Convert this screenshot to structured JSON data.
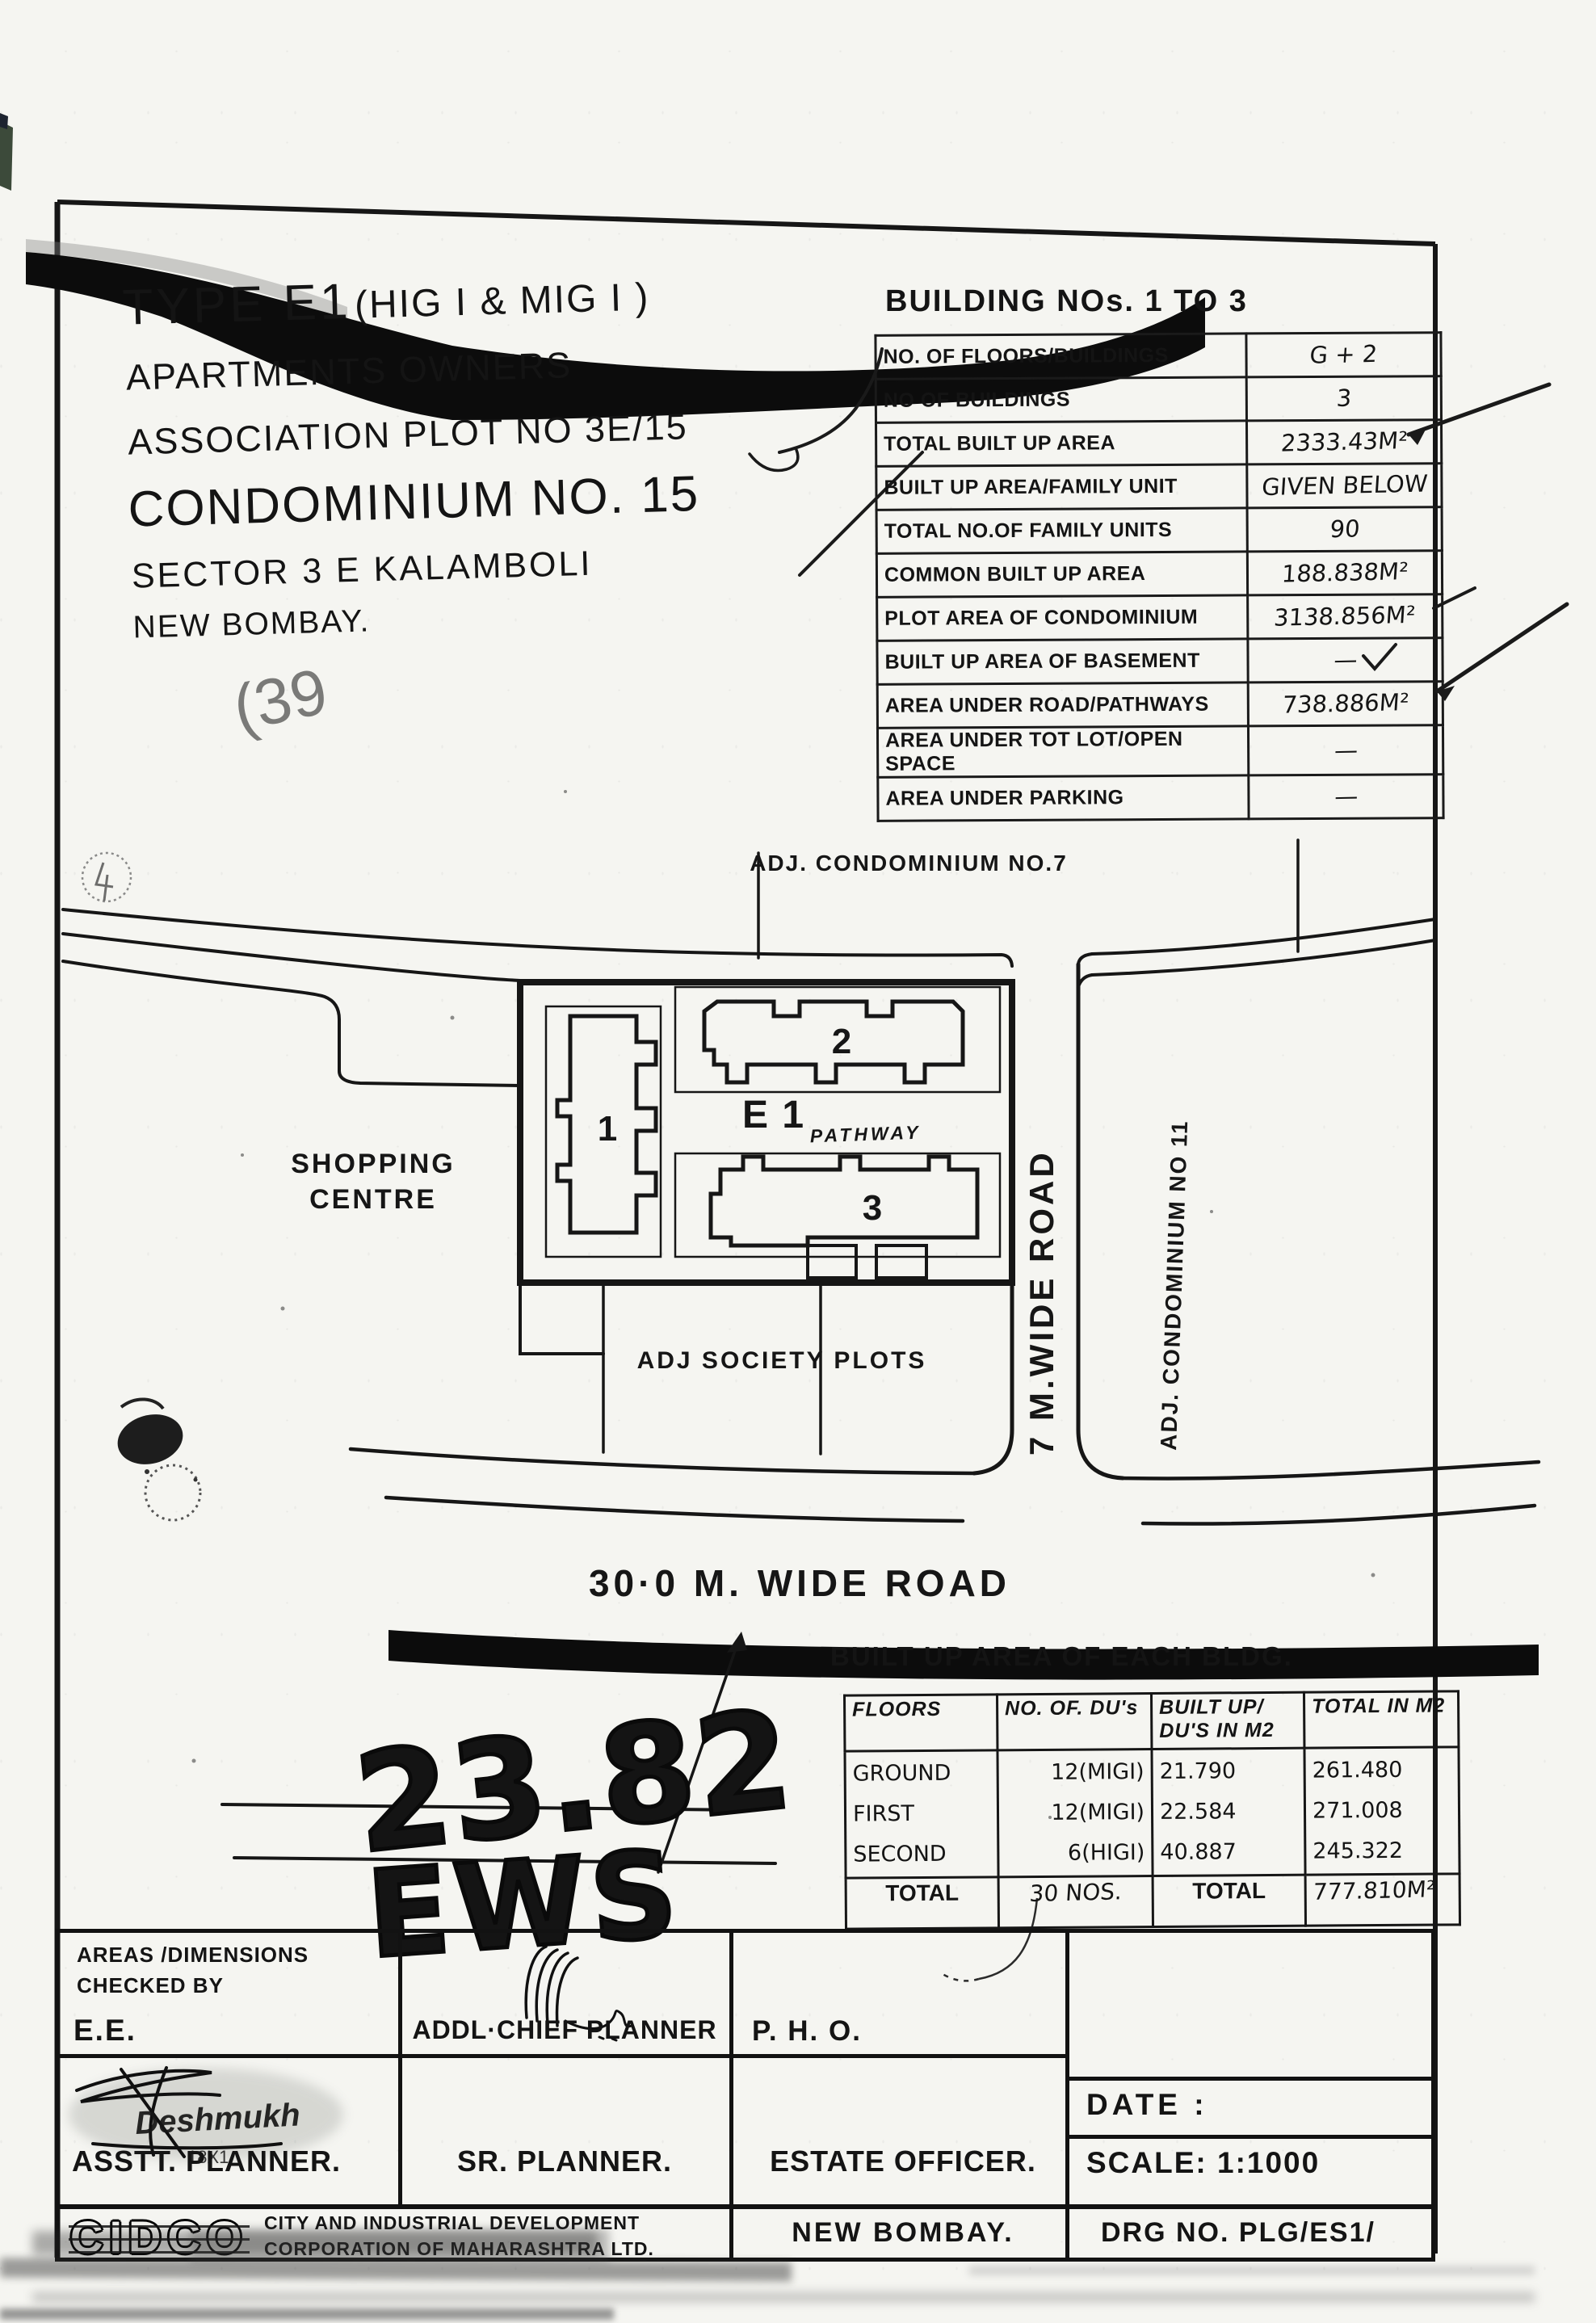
{
  "title_block": {
    "line1a": "TYPE   E1",
    "line1b": "(HIG I & MIG I )",
    "line2": "APARTMENTS  OWNERS",
    "line3": "ASSOCIATION   PLOT  NO 3E/15",
    "line4": "CONDOMINIUM NO. 15",
    "line5": "SECTOR 3 E  KALAMBOLI",
    "line6": "NEW BOMBAY."
  },
  "building_table": {
    "title": "BUILDING  NOs. 1 TO 3",
    "rows": [
      {
        "label": "NO. OF FLOORS/BUILDINGS",
        "value": "G + 2"
      },
      {
        "label": "NO  OF  BUILDINGS",
        "value": "3"
      },
      {
        "label": "TOTAL BUILT UP  AREA",
        "value": "2333.43M²"
      },
      {
        "label": "BUILT  UP AREA/FAMILY  UNIT",
        "value": "GIVEN BELOW"
      },
      {
        "label": "TOTAL  NO.OF  FAMILY  UNITS",
        "value": "90"
      },
      {
        "label": "COMMON  BUILT UP  AREA",
        "value": "188.838M²"
      },
      {
        "label": "PLOT  AREA  OF  CONDOMINIUM",
        "value": "3138.856M²"
      },
      {
        "label": "BUILT UP AREA OF BASEMENT",
        "value": "—"
      },
      {
        "label": "AREA  UNDER  ROAD/PATHWAYS",
        "value": "738.886M²"
      },
      {
        "label": "AREA  UNDER  TOT LOT/OPEN SPACE",
        "value": "—"
      },
      {
        "label": "AREA UNDER  PARKING",
        "value": "—"
      }
    ]
  },
  "plan": {
    "adj_condo_7": "ADJ. CONDOMINIUM  NO.7",
    "shopping_line1": "SHOPPING",
    "shopping_line2": "CENTRE",
    "bldg1": "1",
    "bldg2": "2",
    "bldg3": "3",
    "e1": "E 1",
    "pathway": "PATHWAY",
    "adj_society": "ADJ  SOCIETY   PLOTS",
    "road7": "7 M.WIDE ROAD",
    "adj_condo_11": "ADJ.  CONDOMINIUM  NO 11",
    "road30": "30·0 M. WIDE ROAD"
  },
  "floors_table": {
    "title": "BUILT UP  AREA  OF  EACH  BLDG.",
    "headers": [
      "FLOORS",
      "NO. OF. DU's",
      "BUILT UP/ DU'S IN M2",
      "TOTAL IN M2"
    ],
    "rows": [
      [
        "GROUND",
        "12(MIGI)",
        "21.790",
        "261.480"
      ],
      [
        "FIRST",
        "12(MIGI)",
        "22.584",
        "271.008"
      ],
      [
        "SECOND",
        "6(HIGI)",
        "40.887",
        "245.322"
      ]
    ],
    "total": [
      "TOTAL",
      "30 NOS.",
      "TOTAL",
      "777.810M²"
    ]
  },
  "signature_block": {
    "checked_line1": "AREAS /DIMENSIONS",
    "checked_line2": "CHECKED BY",
    "ee": "E.E.",
    "addl_chief_planner": "ADDL·CHIEF  PLANNER",
    "pho": "P. H. O.",
    "asst_planner": "ASSTT. PLANNER.",
    "sr_planner": "SR. PLANNER.",
    "estate_officer": "ESTATE  OFFICER.",
    "date_label": "DATE  :",
    "scale_label": "SCALE: 1:1000",
    "logo": "CIDCO",
    "org_line1": "CITY AND INDUSTRIAL DEVELOPMENT",
    "org_line2": "CORPORATION OF MAHARASHTRA LTD.",
    "new_bombay": "NEW  BOMBAY.",
    "drg_no": "DRG NO.  PLG/ES1/"
  },
  "annotations": {
    "hand_number": "23.82",
    "hand_word": "EWS",
    "pencil_note": "(39",
    "sig_name": "Deshmukh",
    "sig_sub": "18X1"
  }
}
